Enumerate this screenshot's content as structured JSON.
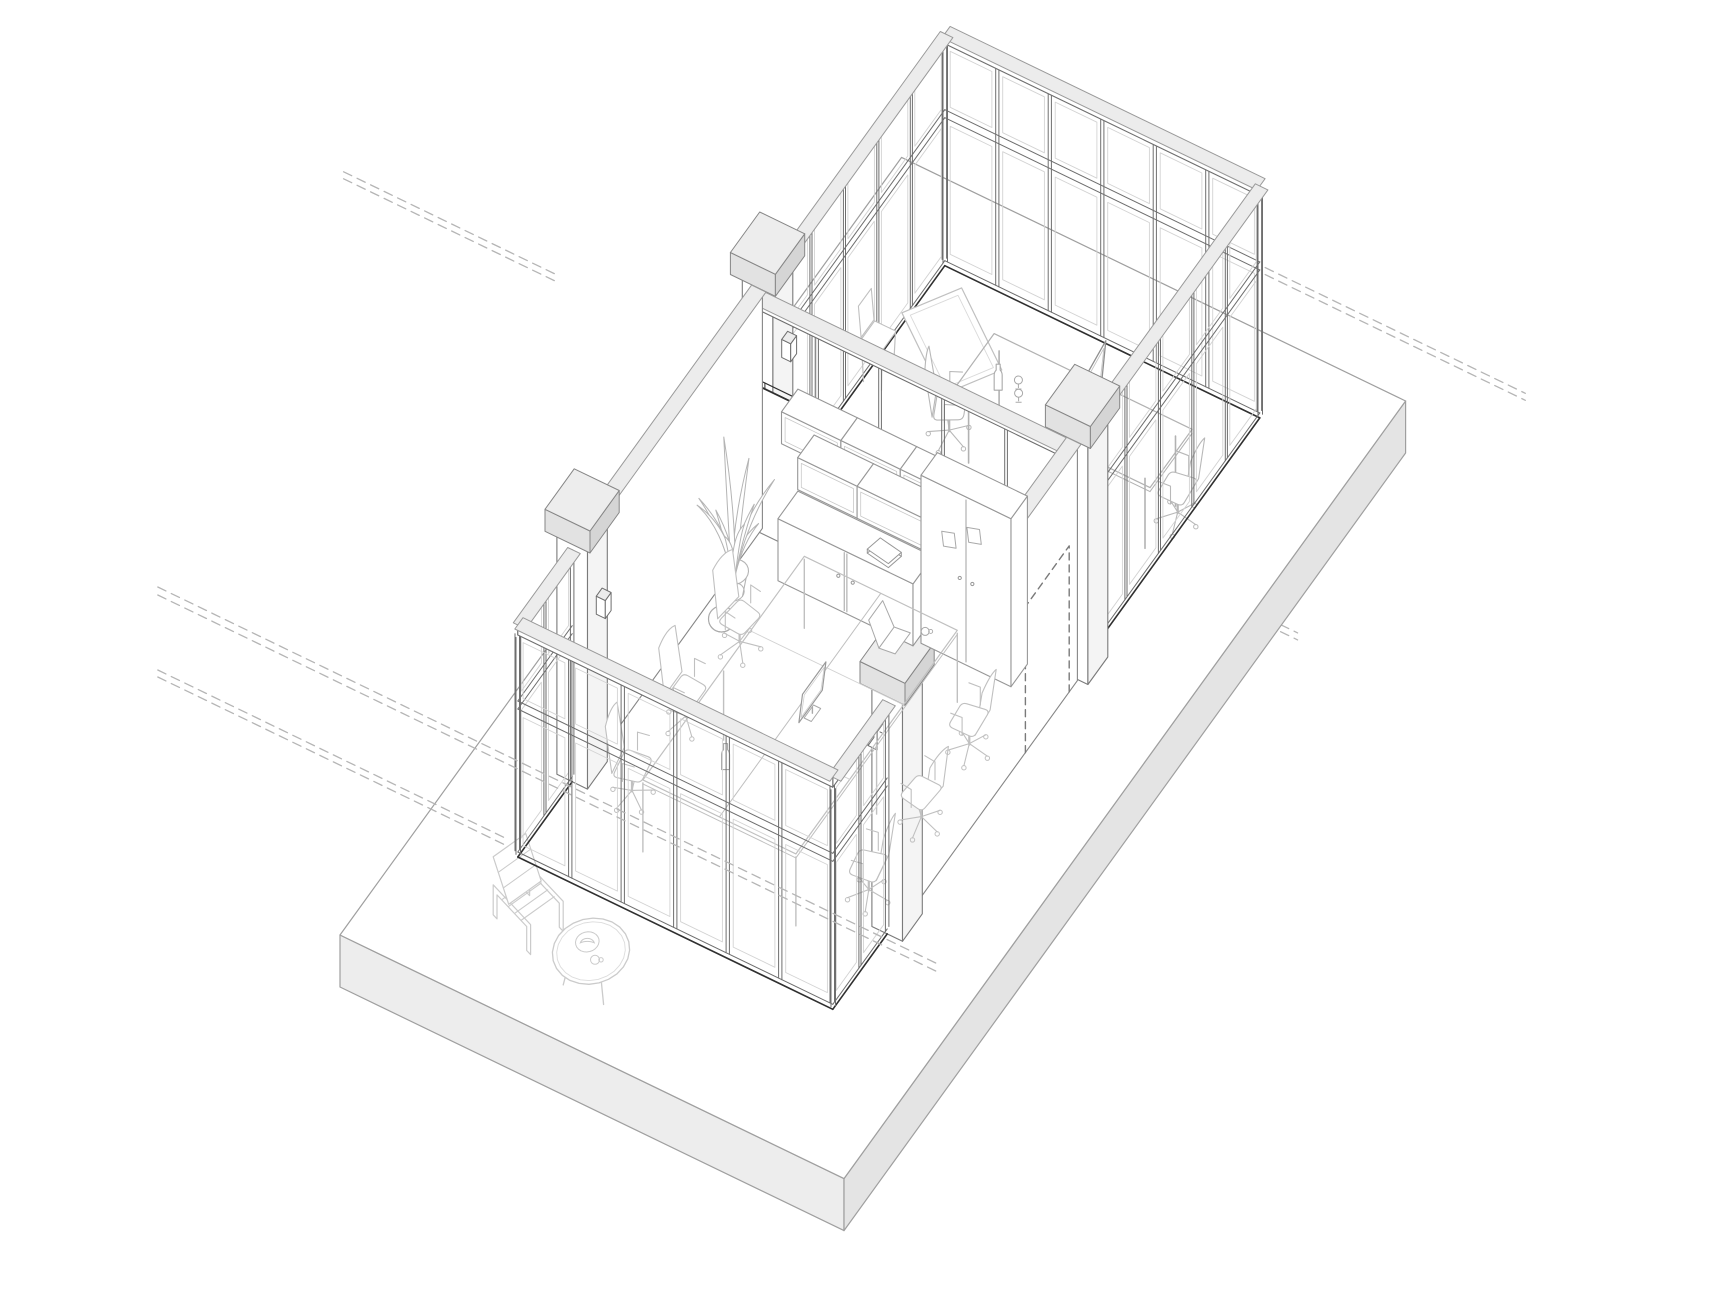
{
  "meta": {
    "title": "Axonometric line drawing of a glazed office pavilion interior",
    "domain": "architectural-axonometric-drawing"
  },
  "canvas": {
    "width": 1733,
    "height": 1300,
    "background": "#ffffff"
  },
  "projection": {
    "origin": [
      340,
      935
    ],
    "u": [
      0.9,
      0.435
    ],
    "v": [
      0.585,
      -0.81
    ],
    "zscale": 1
  },
  "palette": {
    "white": "#ffffff",
    "line": "#6e6e6e",
    "line_dark": "#474747",
    "line_med": "#868686",
    "line_light": "#9b9b9b",
    "track": "#2f2f2f",
    "band_fill": "#ececec",
    "band_edge": "#9a9a9a",
    "slab_side_a": "#ededed",
    "slab_side_b": "#e4e4e4",
    "slab_edge": "#9f9f9f",
    "cap_top": "#ededed",
    "cap_side_a": "#e2e2e2",
    "cap_side_b": "#d5d5d5",
    "pier_side": "#f4f4f4",
    "pier_edge": "#7a7a7a",
    "furniture": "#c0c0c0",
    "furniture_light": "#cbcbcb",
    "shelf": "#979797",
    "item": "#a9a9a9",
    "pane_inner": "#d3d3d3",
    "dash": "#b5b5b5",
    "dash_door": "#7a7a7a"
  },
  "heights": {
    "sill": 5,
    "glass_top": 148,
    "transom_top": 156,
    "head": 222,
    "head_top": 232,
    "solid_wall": 238,
    "pier": 246,
    "cap": 22,
    "spine_solid": 146
  },
  "slab": {
    "size_u": 560,
    "size_v": 960,
    "thickness": 52
  },
  "suite": {
    "u0": 100,
    "u1": 450,
    "front_v": 150,
    "back_v": 880,
    "spine_v": 560
  },
  "walls": {
    "ne": {
      "v": 880,
      "u0": 100,
      "u1": 450,
      "bays": 6
    },
    "front": {
      "v": 150,
      "u0": 100,
      "u1": 450,
      "bays": 6
    },
    "nw_front": {
      "u": 100,
      "v0": 150,
      "v1": 243,
      "bays": 2
    },
    "nw_upper": {
      "u": 100,
      "v0": 594,
      "v1": 880,
      "bays": 5
    },
    "se_front": {
      "u": 450,
      "v0": 150,
      "v1": 243,
      "bays": 2
    },
    "se_upper": {
      "u": 450,
      "v0": 594,
      "v1": 880,
      "bays": 5
    },
    "nw_mid": {
      "u": 100,
      "v0": 277,
      "v1": 559
    },
    "se_mid": {
      "u": 450,
      "v0": 277,
      "v1": 559,
      "door": {
        "v0": 470,
        "v1": 545,
        "h": 146
      }
    },
    "spine": {
      "v": 560,
      "u0": 100,
      "u1": 450,
      "posts": [
        170,
        240,
        310,
        380
      ]
    }
  },
  "piers": [
    {
      "name": "pier-front-nw",
      "u": 100,
      "v": 260,
      "lamp": 1
    },
    {
      "name": "pier-spine-nw",
      "u": 100,
      "v": 577,
      "lamp": 1
    },
    {
      "name": "pier-front-se",
      "u": 450,
      "v": 260,
      "lamp": -1
    },
    {
      "name": "pier-spine-se",
      "u": 450,
      "v": 577,
      "lamp": -1
    }
  ],
  "reference_lines": [
    {
      "name": "spine-extension-nw",
      "v": 560,
      "z": [
        146,
        153
      ],
      "u0": -360,
      "u1": -120
    },
    {
      "name": "spine-extension-se",
      "v": 560,
      "z": [
        146,
        153
      ],
      "u0": 456,
      "u1": 700
    },
    {
      "name": "ne-extension-se",
      "v": 880,
      "z": [
        146,
        153
      ],
      "u0": 456,
      "u1": 745
    },
    {
      "name": "front-base-ext-nw",
      "v": 150,
      "z": [
        6,
        13
      ],
      "u0": -300,
      "u1": 88
    },
    {
      "name": "front-datum",
      "v": 150,
      "z": [
        88,
        96
      ],
      "u0": -300,
      "u1": 565
    }
  ],
  "furniture": {
    "terrace": {
      "lounge_chair": {
        "u": 150,
        "v": 92,
        "angle": -20
      },
      "coffee_table": {
        "u": 236,
        "v": 66,
        "r": 36
      }
    },
    "office": {
      "desks": {
        "u0": 200,
        "u1": 370,
        "v0": 210,
        "v1": 486,
        "modules": 3,
        "height": 72
      },
      "monitor": {
        "u": 298,
        "v": 346
      },
      "laptop": {
        "u": 324,
        "v": 448
      },
      "cup": {
        "u": 346,
        "v": 468
      },
      "bottle": {
        "u": 262,
        "v": 256
      },
      "chairs": [
        {
          "u": 158,
          "v": 256,
          "face": 10
        },
        {
          "u": 158,
          "v": 348,
          "face": 0
        },
        {
          "u": 158,
          "v": 440,
          "face": -8
        },
        {
          "u": 412,
          "v": 270,
          "face": 190
        },
        {
          "u": 412,
          "v": 360,
          "face": 175
        },
        {
          "u": 408,
          "v": 448,
          "face": 185
        }
      ],
      "plant": {
        "u": 120,
        "v": 488
      },
      "basketball": {
        "u": 134,
        "v": 446
      },
      "credenza": {
        "u0": 150,
        "u1": 300,
        "v0": 518,
        "v1": 552,
        "h": 62
      },
      "shelf_boxes": [
        {
          "u0": 150,
          "u1": 216,
          "z0": 132,
          "z1": 164
        },
        {
          "u0": 216,
          "u1": 282,
          "z0": 132,
          "z1": 164
        },
        {
          "u0": 282,
          "u1": 330,
          "z0": 132,
          "z1": 164
        },
        {
          "u0": 168,
          "u1": 234,
          "z0": 94,
          "z1": 126
        },
        {
          "u0": 234,
          "u1": 312,
          "z0": 94,
          "z1": 126
        }
      ],
      "cabinet": {
        "u0": 305,
        "u1": 405,
        "v0": 524,
        "v1": 552,
        "h": 168
      },
      "book": {
        "u": 258,
        "v": 534
      },
      "cards": [
        {
          "u": 330,
          "z": 108
        },
        {
          "u": 358,
          "z": 124
        }
      ]
    },
    "meeting": {
      "table": {
        "u0": 225,
        "u1": 445,
        "v0": 700,
        "v1": 772,
        "h": 74
      },
      "tv": {
        "u": 350,
        "v": 740
      },
      "bottle": {
        "u": 262,
        "v": 722
      },
      "glasses": [
        {
          "u": 278,
          "v": 732
        },
        {
          "u": 286,
          "v": 720
        }
      ],
      "chairs": [
        {
          "u": 205,
          "v": 726,
          "face": 25
        },
        {
          "u": 442,
          "v": 752,
          "face": 185
        }
      ],
      "stool": {
        "u": 112,
        "v": 748
      },
      "whiteboard": {
        "u": 152,
        "v": 812,
        "w": 100,
        "h": 60,
        "rot": -35
      }
    },
    "plant_leaves": {
      "angles": [
        8,
        40,
        70,
        100,
        135,
        170,
        205,
        245,
        285,
        320
      ],
      "lengths": [
        62,
        92,
        58,
        88,
        104,
        54,
        78,
        96,
        66,
        84
      ]
    }
  }
}
